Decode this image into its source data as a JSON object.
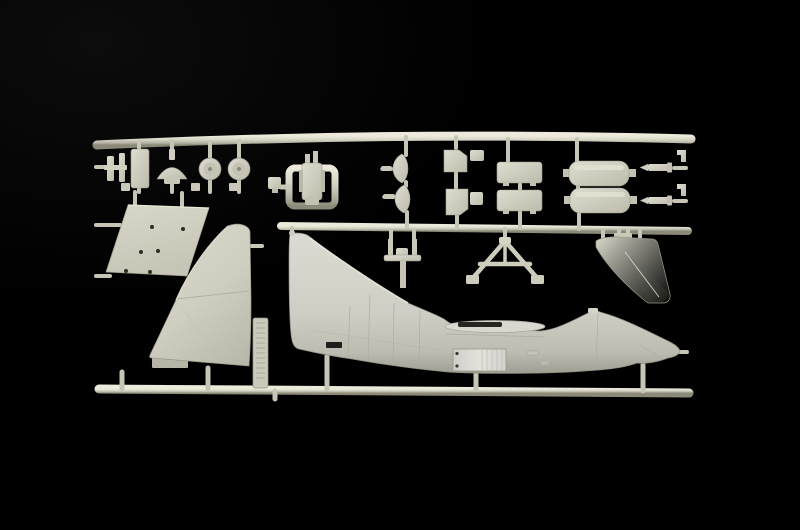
{
  "scene": {
    "description": "Photograph of a light grey injection-moulded polystyrene model-kit sprue (A-7 Corsair II style aircraft parts) on a black background",
    "background_color": "#000000",
    "plastic_colors": {
      "highlight": "#e9e8da",
      "base": "#d3d2c4",
      "mid_shadow": "#aeada0",
      "deep_shadow": "#83826f",
      "recess_dark": "#23231f"
    }
  },
  "parts": {
    "sprue_frame": {
      "label": "rectangular sprue frame with runners and gates"
    },
    "fuselage_half": {
      "label": "large fuselage half with integral tail fin, wing-root slot and open landing-gear bay"
    },
    "wing_panel_large": {
      "label": "large swept wing / fin panel"
    },
    "flat_panel": {
      "label": "flat parallelogram panel with locating holes",
      "hole_count": 6
    },
    "label_tab": {
      "label": "vertical moulded manufacturer label tab (embossed text, illegible)"
    },
    "stabilizer_fin": {
      "label": "separate swept stabilizer fin"
    },
    "ejection_seat": {
      "label": "ejection seat moulded inside square runner loop"
    },
    "clamp_bracket": {
      "label": "small clamp bracket"
    },
    "access_door": {
      "label": "small rectangular access door"
    },
    "domed_cap": {
      "label": "mushroom-shaped domed cap"
    },
    "wheels": {
      "label": "two main wheels",
      "count": 2
    },
    "intake_lips": {
      "label": "two curved intake-lip halves",
      "count": 2
    },
    "small_doors": {
      "label": "four small door / bracket pieces",
      "count": 4
    },
    "pylons": {
      "label": "two rectangular weapon pylons",
      "count": 2
    },
    "fuel_tank_halves": {
      "label": "two long drop-tank halves",
      "count": 2
    },
    "missiles": {
      "label": "two small missile bodies",
      "count": 2
    },
    "angle_tabs": {
      "label": "two small angle brackets on right rail",
      "count": 2
    },
    "gear_leg": {
      "label": "landing-gear leg with cross beam"
    },
    "gear_truss": {
      "label": "A-frame landing-gear truss"
    }
  }
}
